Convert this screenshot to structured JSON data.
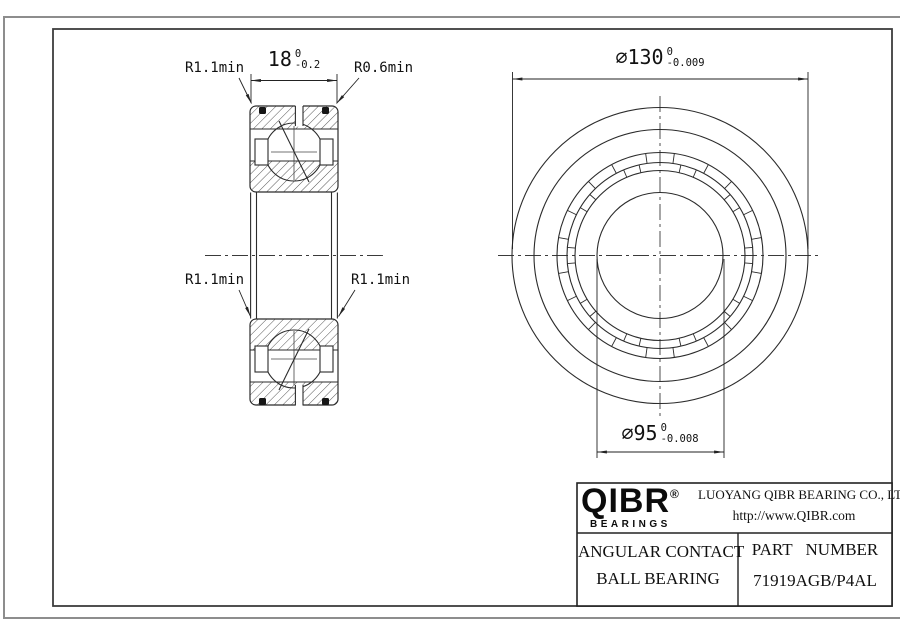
{
  "dims": {
    "width": {
      "value": "18",
      "tol_upper": "0",
      "tol_lower": "-0.2"
    },
    "od": {
      "value": "∅130",
      "tol_upper": "0",
      "tol_lower": "-0.009"
    },
    "bore": {
      "value": "∅95",
      "tol_upper": "0",
      "tol_lower": "-0.008"
    },
    "r_top_left": "R1.1min",
    "r_top_right": "R0.6min",
    "r_mid_left": "R1.1min",
    "r_mid_right": "R1.1min"
  },
  "title_block": {
    "logo_text": "QIBR",
    "logo_registered": "®",
    "logo_tagline": "BEARINGS",
    "company_name": "LUOYANG QIBR BEARING CO., LTD",
    "website": "http://www.QIBR.com",
    "product_type_line1": "ANGULAR CONTACT",
    "product_type_line2": "BALL BEARING",
    "part_number_label": "PART NUMBER",
    "part_number": "71919AGB/P4AL"
  },
  "colors": {
    "drawing_line": "#2b2b2b",
    "outer_border": "#8d8d8d",
    "text": "#111111"
  }
}
